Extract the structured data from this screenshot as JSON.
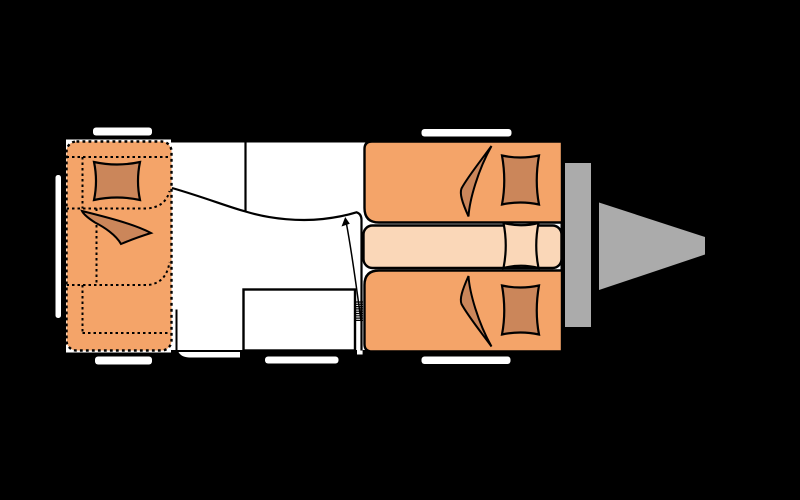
{
  "app": {
    "description": "caravan-floor-plan-top-view",
    "canvas": {
      "width": 800,
      "height": 500,
      "background": "#000000"
    }
  },
  "colors": {
    "background": "#000000",
    "floor": "#FFFFFF",
    "outline": "#000000",
    "upholstery_orange": "#F4A469",
    "cushion_dark_orange": "#CB865A",
    "mattress_light": "#FAD7B8",
    "drawbar_gray": "#ABABAB"
  },
  "plan": {
    "items": [
      {
        "name": "body-floor",
        "type": "rect",
        "attrs": {
          "x": 66,
          "y": 139.5,
          "width": 497,
          "height": 213,
          "fill": "#FFFFFF"
        }
      },
      {
        "name": "window-top-left",
        "type": "rect",
        "attrs": {
          "x": 93,
          "y": 127.5,
          "width": 59,
          "height": 8,
          "rx": 3,
          "fill": "#FFFFFF"
        }
      },
      {
        "name": "window-top-right",
        "type": "rect",
        "attrs": {
          "x": 421.5,
          "y": 129,
          "width": 90,
          "height": 7.5,
          "rx": 3,
          "fill": "#FFFFFF"
        }
      },
      {
        "name": "window-left-side",
        "type": "rect",
        "attrs": {
          "x": 55.5,
          "y": 175,
          "width": 5.5,
          "height": 143,
          "rx": 2.5,
          "fill": "#FFFFFF"
        }
      },
      {
        "name": "window-bottom-left",
        "type": "rect",
        "attrs": {
          "x": 95,
          "y": 356.5,
          "width": 57,
          "height": 8,
          "rx": 3,
          "fill": "#FFFFFF"
        }
      },
      {
        "name": "window-bottom-middle",
        "type": "rect",
        "attrs": {
          "x": 265,
          "y": 356.5,
          "width": 73.5,
          "height": 7,
          "rx": 3,
          "fill": "#FFFFFF"
        }
      },
      {
        "name": "window-bottom-right",
        "type": "rect",
        "attrs": {
          "x": 421.5,
          "y": 356.5,
          "width": 89,
          "height": 7.5,
          "rx": 3,
          "fill": "#FFFFFF"
        }
      },
      {
        "name": "drawbar-crossmember",
        "type": "rect",
        "attrs": {
          "x": 565,
          "y": 163,
          "width": 26,
          "height": 164,
          "fill": "#ABABAB"
        }
      },
      {
        "name": "drawbar-hitch",
        "type": "polygon",
        "attrs": {
          "points": "599,202.5 705,237 705,254.5 599,290",
          "fill": "#ABABAB"
        }
      },
      {
        "name": "body-walls",
        "type": "path",
        "attrs": {
          "d": "M 171,141 H 562 V 351.5 H 171",
          "fill": "none",
          "stroke": "#000000",
          "stroke-width": 3
        }
      },
      {
        "name": "service-hatch",
        "type": "path",
        "attrs": {
          "d": "M 178.5,352 L 240,352 L 240,357.5 L 189,357.5 C 183,357 180,355 178.5,352 Z",
          "fill": "#FFFFFF"
        }
      },
      {
        "name": "entry-door-gap",
        "type": "rect",
        "attrs": {
          "x": 357,
          "y": 349,
          "width": 5.6,
          "height": 5.5,
          "fill": "#FFFFFF"
        }
      },
      {
        "name": "washroom-partition-line",
        "type": "path",
        "attrs": {
          "d": "M 245.5,141 V 211.5",
          "fill": "none",
          "stroke": "#000000",
          "stroke-width": 2.2
        }
      },
      {
        "name": "washroom-curved-wall",
        "type": "path",
        "attrs": {
          "d": "M 172,188 C 205,197.5 227,206.5 245.5,211.5 C 272,219.5 301,221.5 323,219 C 338.5,217.2 351,214 356.5,212.3 Q 361.5,213.8 361.5,220 L 361.5,350.5",
          "fill": "none",
          "stroke": "#000000",
          "stroke-width": 2.2
        }
      },
      {
        "name": "wall-stub",
        "type": "path",
        "attrs": {
          "d": "M 176.5,309.5 V 351",
          "fill": "none",
          "stroke": "#000000",
          "stroke-width": 2
        }
      },
      {
        "name": "kitchen-unit",
        "type": "rect",
        "attrs": {
          "x": 243.5,
          "y": 289.5,
          "width": 111.5,
          "height": 61,
          "fill": "#FFFFFF",
          "stroke": "#000000",
          "stroke-width": 2.4
        }
      },
      {
        "name": "dinette-bed-conversion",
        "type": "rect",
        "attrs": {
          "x": 66.5,
          "y": 141.5,
          "width": 105,
          "height": 209,
          "rx": 10,
          "fill": "#F4A469",
          "stroke": "#000000",
          "stroke-width": 2.4,
          "stroke-dasharray": "2.8 3.2"
        }
      },
      {
        "name": "dinette-backrest-line",
        "type": "path",
        "attrs": {
          "d": "M 66.5,157 H 170",
          "fill": "none",
          "stroke": "#000000",
          "stroke-width": 2,
          "stroke-dasharray": "2.5 3"
        }
      },
      {
        "name": "dinette-divider-v1",
        "type": "path",
        "attrs": {
          "d": "M 82.5,157 V 208.5",
          "fill": "none",
          "stroke": "#000000",
          "stroke-width": 2,
          "stroke-dasharray": "2.5 3"
        }
      },
      {
        "name": "dinette-mid-line",
        "type": "path",
        "attrs": {
          "d": "M 66.5,208.5 H 146 Q 165.5,207.5 169.5,191",
          "fill": "none",
          "stroke": "#000000",
          "stroke-width": 2,
          "stroke-dasharray": "2.5 3"
        }
      },
      {
        "name": "dinette-divider-v2",
        "type": "path",
        "attrs": {
          "d": "M 96.5,208.5 V 285",
          "fill": "none",
          "stroke": "#000000",
          "stroke-width": 2,
          "stroke-dasharray": "2.5 3"
        }
      },
      {
        "name": "dinette-seat-line",
        "type": "path",
        "attrs": {
          "d": "M 66.5,285 H 148 Q 166.5,283 169.5,262",
          "fill": "none",
          "stroke": "#000000",
          "stroke-width": 2,
          "stroke-dasharray": "2.5 3"
        }
      },
      {
        "name": "dinette-divider-v3",
        "type": "path",
        "attrs": {
          "d": "M 82.5,285 V 333",
          "fill": "none",
          "stroke": "#000000",
          "stroke-width": 2,
          "stroke-dasharray": "2.5 3"
        }
      },
      {
        "name": "dinette-foot-line",
        "type": "path",
        "attrs": {
          "d": "M 82.5,333 H 170",
          "fill": "none",
          "stroke": "#000000",
          "stroke-width": 2,
          "stroke-dasharray": "2.5 3"
        }
      },
      {
        "name": "dinette-pillow",
        "type": "path",
        "attrs": {
          "d": "M 94,162 Q 117,167 140,162 Q 136,181 140,200 Q 117,195 94,200 Q 98,181 94,162 Z",
          "fill": "#CB865A",
          "stroke": "#000000",
          "stroke-width": 2.2
        }
      },
      {
        "name": "dinette-blanket",
        "type": "path",
        "attrs": {
          "d": "M 82,211 C 106,217 134,224 151,233 C 140,236.5 128,241 121,244 C 116,235 104,227 95,222.5 C 88,218 83.5,214 82,211 Z",
          "fill": "#CB865A",
          "stroke": "#000000",
          "stroke-width": 2
        }
      },
      {
        "name": "single-bed-top",
        "type": "path",
        "attrs": {
          "d": "M 372,141.5 L 562,141.5 L 562,222.5 L 379,222.5 Q 364.5,222.5 364.5,208 L 364.5,149 Q 364.5,141.5 372,141.5 Z",
          "fill": "#F4A469",
          "stroke": "#000000",
          "stroke-width": 2.4
        }
      },
      {
        "name": "single-bed-bottom",
        "type": "path",
        "attrs": {
          "d": "M 372,351.5 L 562,351.5 L 562,270.5 L 379,270.5 Q 364.5,270.5 364.5,285 L 364.5,344 Q 364.5,351.5 372,351.5 Z",
          "fill": "#F4A469",
          "stroke": "#000000",
          "stroke-width": 2.4
        }
      },
      {
        "name": "bed-center-step",
        "type": "rect",
        "attrs": {
          "x": 363.5,
          "y": 225.5,
          "width": 198,
          "height": 42.5,
          "rx": 9,
          "fill": "#FAD7B8",
          "stroke": "#000000",
          "stroke-width": 2.4
        }
      },
      {
        "name": "blanket-bed-top",
        "type": "path",
        "attrs": {
          "d": "M 491.5,146 C 479,163 467,178 461.5,188.5 C 459.5,193.5 462,202 468.5,216.5 C 469.5,200 478,170 491.5,146 Z",
          "fill": "#CB865A",
          "stroke": "#000000",
          "stroke-width": 2
        }
      },
      {
        "name": "blanket-bed-bottom",
        "type": "path",
        "attrs": {
          "d": "M 491.5,346.5 C 479,329.5 467,314.5 461.5,304 C 459.5,299 462,290.5 468.5,276 C 469.5,292.5 478,322.5 491.5,346.5 Z",
          "fill": "#CB865A",
          "stroke": "#000000",
          "stroke-width": 2
        }
      },
      {
        "name": "pillow-bed-top",
        "type": "path",
        "attrs": {
          "d": "M 502,155.5 Q 520.5,159.5 539,155.5 Q 534.5,181 539,204.5 Q 520.5,200.5 502,204.5 Q 506.5,181 502,155.5 Z",
          "fill": "#CB865A",
          "stroke": "#000000",
          "stroke-width": 2.2
        }
      },
      {
        "name": "pillow-bed-center",
        "type": "path",
        "attrs": {
          "d": "M 503.5,223 Q 521,227.5 538.5,223 Q 534,245.5 538.5,268 Q 521,263.5 503.5,268 Q 508,245.5 503.5,223 Z",
          "fill": "#FAD7B8",
          "stroke": "#000000",
          "stroke-width": 2.2
        }
      },
      {
        "name": "pillow-bed-bottom",
        "type": "path",
        "attrs": {
          "d": "M 502,285.5 Q 520.5,289.5 539,285.5 Q 534.5,311 539,334.5 Q 520.5,330.5 502,334.5 Q 506.5,311 502,285.5 Z",
          "fill": "#CB865A",
          "stroke": "#000000",
          "stroke-width": 2.2
        }
      },
      {
        "name": "entry-door-spring",
        "type": "path",
        "attrs": {
          "d": "M 354.5,302 H 363 M 354.5,304.3 H 363 M 354.5,306.6 H 363 M 354.5,308.9 H 363 M 354.5,311.2 H 363 M 354.5,313.5 H 363 M 354.5,315.8 H 363 M 354.5,318.1 H 363 M 354.5,320.4 H 363",
          "fill": "none",
          "stroke": "#000000",
          "stroke-width": 1.2
        }
      },
      {
        "name": "door-swing-arrow",
        "type": "path",
        "attrs": {
          "d": "M 361,321 C 356.5,287 351,248 346.5,224",
          "fill": "none",
          "stroke": "#000000",
          "stroke-width": 1.5
        }
      },
      {
        "name": "door-swing-arrowhead",
        "type": "polygon",
        "attrs": {
          "points": "345.2,217 341.5,226.5 349.8,223.8",
          "fill": "#000000"
        }
      }
    ]
  }
}
